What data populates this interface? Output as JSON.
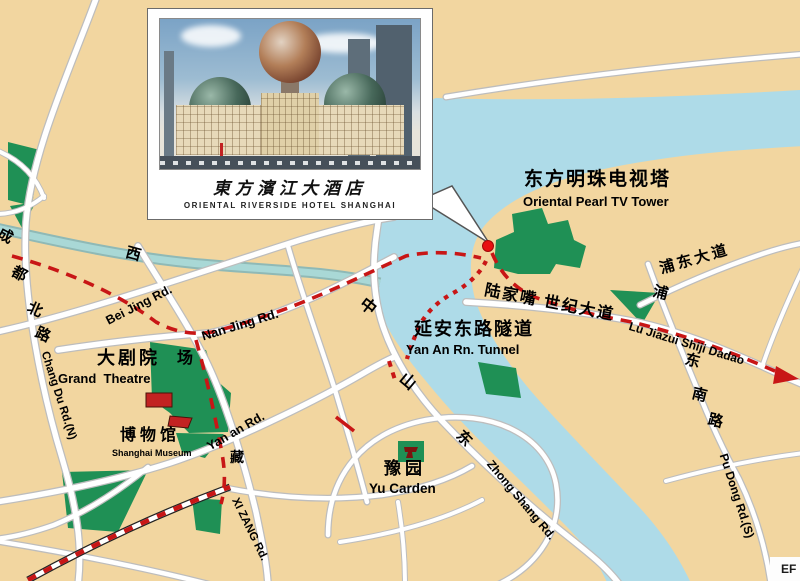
{
  "inset": {
    "calligraphy": "東方濱江大酒店",
    "caption": "ORIENTAL RIVERSIDE HOTEL SHANGHAI"
  },
  "labels": {
    "tv_tower_zh": "东方明珠电视塔",
    "tv_tower_en": "Oriental Pearl TV Tower",
    "tunnel_zh": "延安东路隧道",
    "tunnel_en": "Yan An Rn. Tunnel",
    "grand_theatre_zh": "大剧院",
    "grand_theatre_extra": "场",
    "grand_theatre_en": "Grand  Theatre",
    "museum_zh": "博物馆",
    "museum_en": "Shanghai Museum",
    "yu_garden_zh": "豫园",
    "yu_garden_en": "Yu Carden",
    "bei_jing_rd": "Bei Jing Rd.",
    "nan_jing_rd": "Nan Jing Rd.",
    "yan_an_rd": "Yan an Rd.",
    "chang_du_rd": "Chang Du Rd.(N)",
    "xi_zang_rd": "XI ZANG Rd.",
    "zhong_shang_rd": "Zhong Shang Rd.",
    "pu_dong_rd": "Pu Dong Rd.(S)",
    "pudong_dadao_zh": "浦东大道",
    "lujiazui_zh": "陆家嘴 世纪大道",
    "lujiazui_en": "Lu Jiazui Shiji Dadao",
    "corner_mark": "EF"
  },
  "vertical_chars": {
    "chengdu": [
      "成",
      "都",
      "北",
      "路"
    ],
    "xizang": [
      "西",
      "藏"
    ],
    "zhongshan": [
      "中",
      "山",
      "东"
    ],
    "pudongnan": [
      "浦",
      "东",
      "南",
      "路"
    ]
  },
  "colors": {
    "land": "#F2D6A0",
    "river": "#AEDBE8",
    "creek": "#A9D8D6",
    "creekedge": "#8FB9B6",
    "green": "#1F9055",
    "road": "#FFFFFF",
    "casing": "#BDBDBD",
    "route": "#C81616",
    "dot": "#E81010",
    "icon": "#C22222"
  }
}
